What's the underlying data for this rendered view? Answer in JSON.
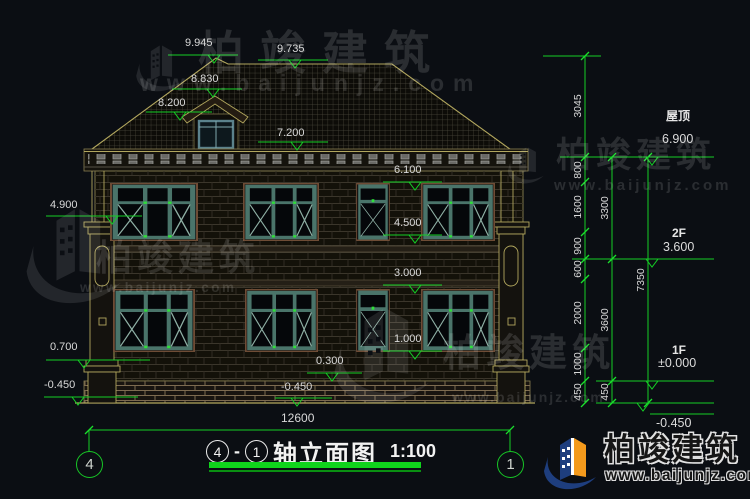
{
  "watermark": {
    "brand": "柏竣建筑",
    "site": "www.baijunjz.com"
  },
  "logo": {
    "brand": "柏竣建筑",
    "site": "www.baijunjz.com"
  },
  "title": {
    "axis_start": "4",
    "separator": "-",
    "axis_end": "1",
    "text": "轴立面图",
    "scale": "1:100"
  },
  "axes": {
    "left": "4",
    "right": "1"
  },
  "levels": {
    "facade": {
      "l9945": "9.945",
      "l9735": "9.735",
      "l8830": "8.830",
      "l8200": "8.200",
      "l7200": "7.200",
      "l6100": "6.100",
      "l4500": "4.500",
      "l3000": "3.000",
      "l1000": "1.000",
      "l0300": "0.300",
      "lneg450": "-0.450"
    },
    "left": {
      "l4900": "4.900",
      "l0700": "0.700",
      "lneg450": "-0.450"
    },
    "right": [
      {
        "name": "屋顶",
        "value": "6.900"
      },
      {
        "name": "2F",
        "value": "3.600"
      },
      {
        "name": "1F",
        "value": "±0.000"
      },
      {
        "name": "",
        "value": "-0.450"
      }
    ]
  },
  "dimensions": {
    "roof_rise": "3045",
    "chain_inner": [
      "800",
      "1600",
      "900",
      "600",
      "2000",
      "1000",
      "450"
    ],
    "chain_outer": [
      "3300",
      "3600",
      "450"
    ],
    "total_height": "7350",
    "total_width": "12600"
  }
}
